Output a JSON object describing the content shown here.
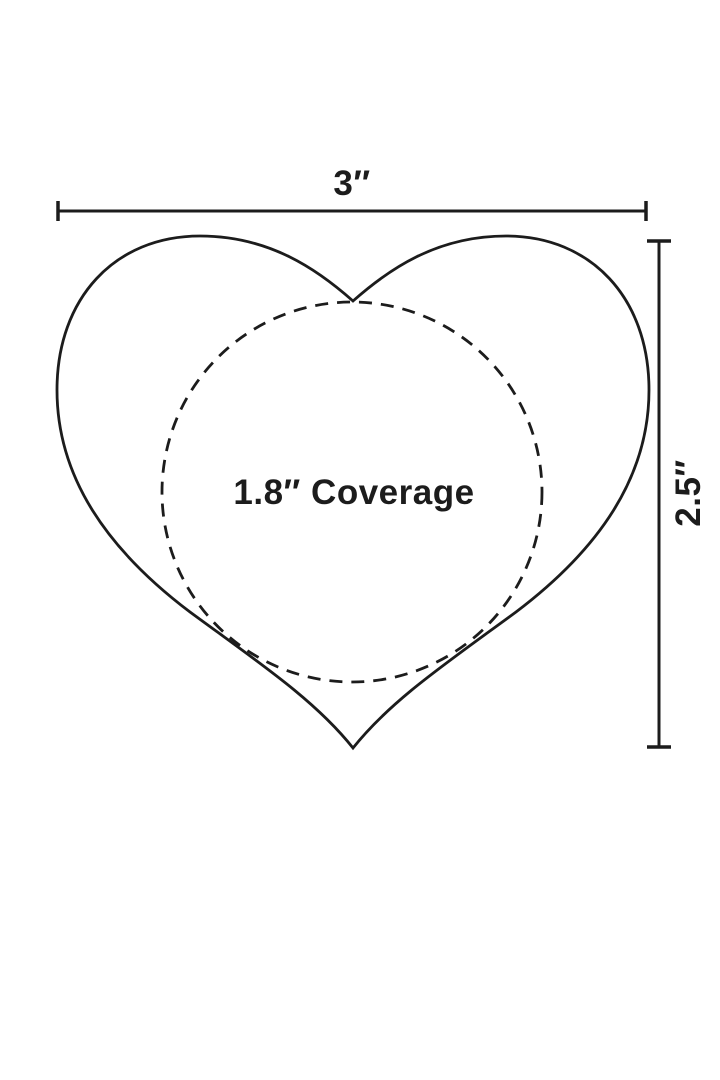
{
  "diagram": {
    "width_label": "3″",
    "height_label": "2.5″",
    "coverage_label": "1.8″ Coverage",
    "colors": {
      "stroke": "#1c1c1c",
      "background": "#ffffff"
    }
  }
}
